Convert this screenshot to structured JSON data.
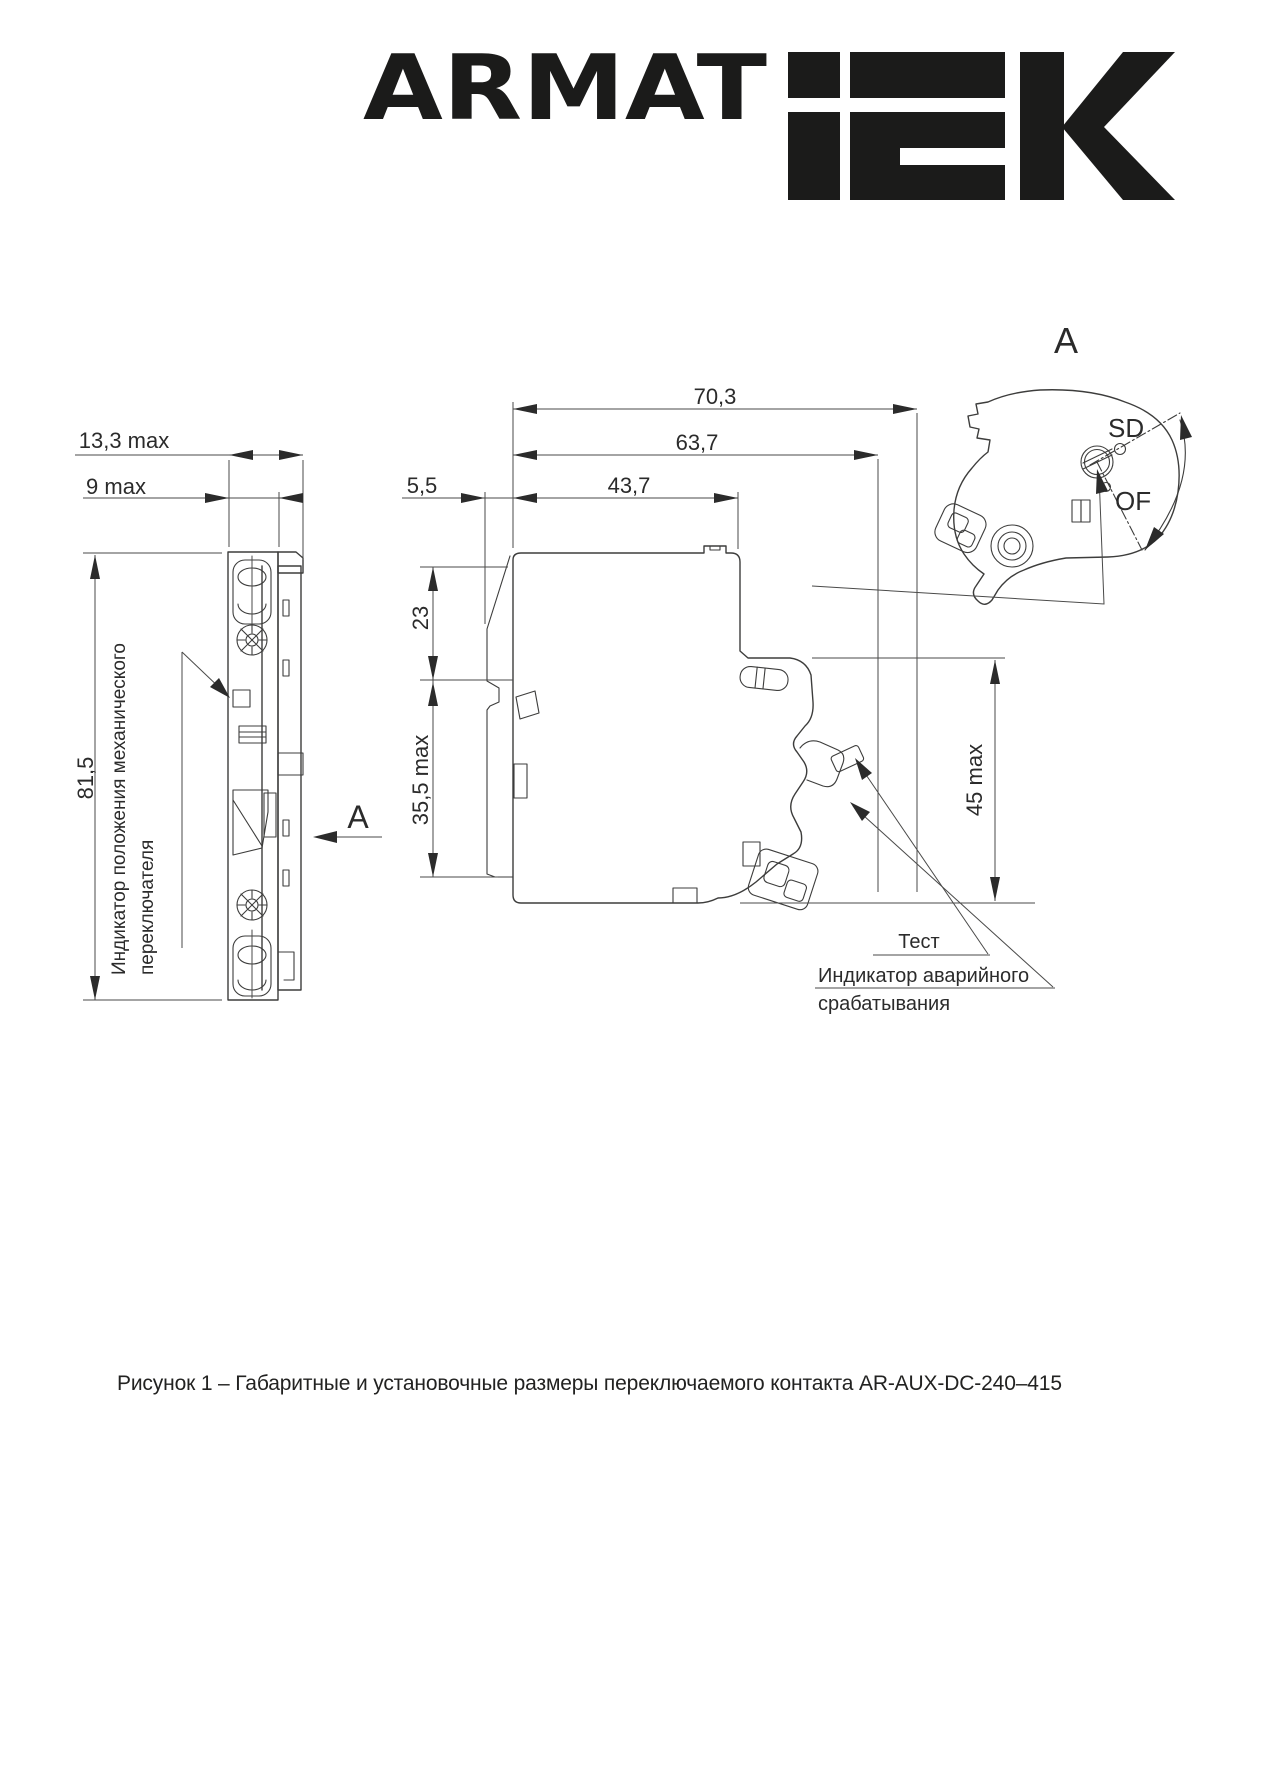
{
  "colors": {
    "ink": "#1b1b1a",
    "line": "#3d3d3c",
    "text": "#2b2b2b",
    "background": "#ffffff"
  },
  "logo": {
    "armat": "ARMAT",
    "iek_alt": "IEK"
  },
  "front_view": {
    "dim_width_total": "13,3 max",
    "dim_width_body": "9 max",
    "dim_height": "81,5",
    "indicator_label_line1": "Индикатор положения механического",
    "indicator_label_line2": "переключателя",
    "section_arrow_label": "A"
  },
  "side_view": {
    "dim_depth_total": "70,3",
    "dim_depth_latched": "63,7",
    "dim_front_offset": "5,5",
    "dim_depth_body": "43,7",
    "dim_upper_front": "23",
    "dim_front_panel": "35,5 max",
    "dim_rear_height": "45 max",
    "test_label": "Тест",
    "trip_label_line1": "Индикатор аварийного",
    "trip_label_line2": "срабатывания"
  },
  "detail_view": {
    "title": "A",
    "position_sd": "SD",
    "position_of": "OF"
  },
  "caption": {
    "text": "Рисунок 1 – Габаритные и установочные размеры переключаемого контакта AR-AUX-DC-240–415"
  }
}
